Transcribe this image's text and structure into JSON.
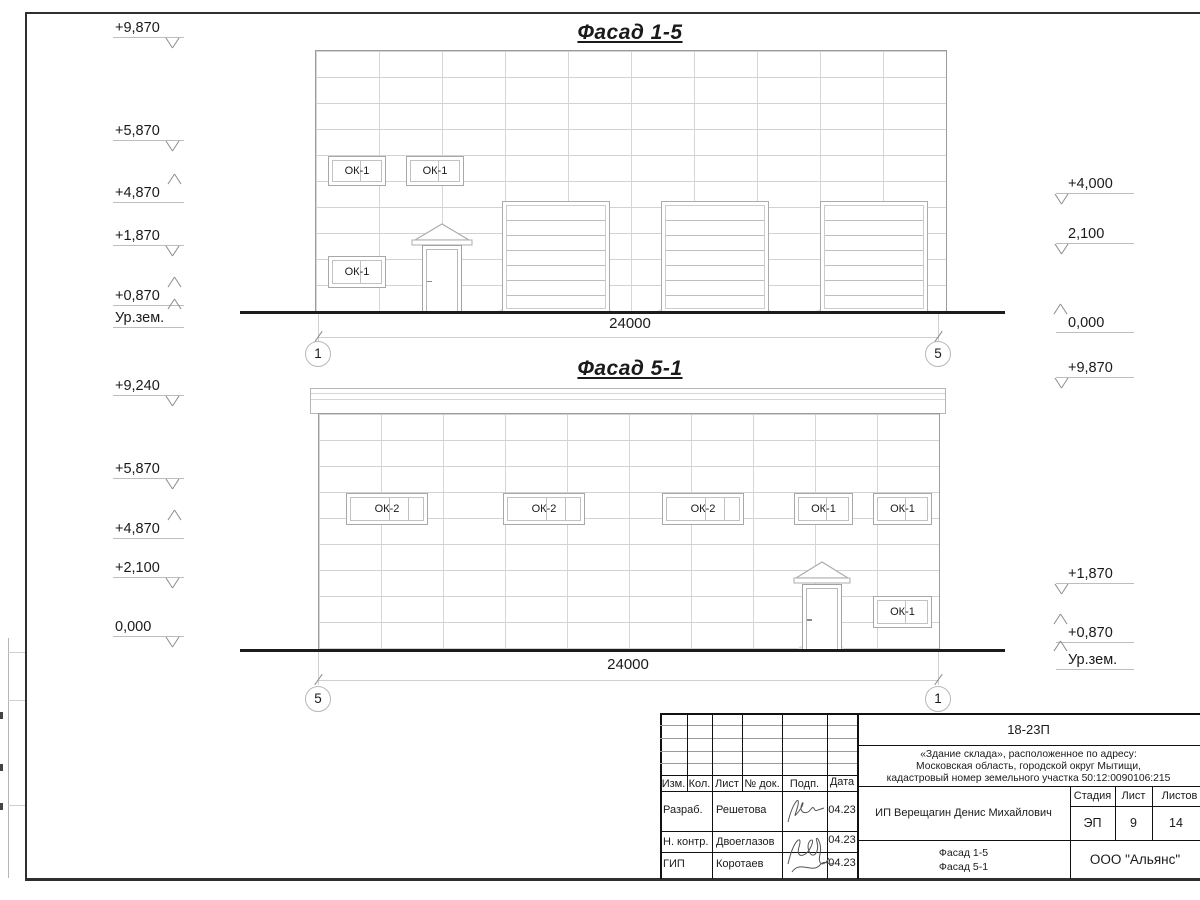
{
  "facade1": {
    "title": "Фасад 1-5",
    "dimension": "24000",
    "axis_left": "1",
    "axis_right": "5",
    "marks_left": [
      "+9,870",
      "+5,870",
      "+4,870",
      "+1,870",
      "+0,870",
      "Ур.зем."
    ],
    "marks_right": [
      "+4,000",
      "2,100",
      "0,000"
    ]
  },
  "facade2": {
    "title": "Фасад 5-1",
    "dimension": "24000",
    "axis_left": "5",
    "axis_right": "1",
    "marks_left": [
      "+9,240",
      "+5,870",
      "+4,870",
      "+2,100",
      "0,000"
    ],
    "marks_right": [
      "+9,870",
      "+1,870",
      "+0,870",
      "Ур.зем."
    ]
  },
  "labels": {
    "ok1": "ОК-1",
    "ok2": "ОК-2"
  },
  "title_block": {
    "doc_number": "18-23П",
    "project_line1": "«Здание склада», расположенное по адресу:",
    "project_line2": "Московская область, городской округ Мытищи,",
    "project_line3": "кадастровый номер земельного участка 50:12:0090106:215",
    "client": "ИП Верещагин Денис Михайлович",
    "stage_label": "Стадия",
    "sheet_label": "Лист",
    "sheets_label": "Листов",
    "stage": "ЭП",
    "sheet_num": "9",
    "sheets_total": "14",
    "content_line1": "Фасад 1-5",
    "content_line2": "Фасад 5-1",
    "company": "ООО \"Альянс\"",
    "cols": {
      "izm": "Изм.",
      "kol": "Кол.",
      "list": "Лист",
      "doc": "№ док.",
      "podp": "Подп.",
      "data": "Дата"
    },
    "rows": [
      {
        "role": "Разраб.",
        "name": "Решетова",
        "date": "04.23"
      },
      {
        "role": "Н. контр.",
        "name": "Двоеглазов",
        "date": "04.23"
      },
      {
        "role": "ГИП",
        "name": "Коротаев",
        "date": "04.23"
      }
    ]
  }
}
